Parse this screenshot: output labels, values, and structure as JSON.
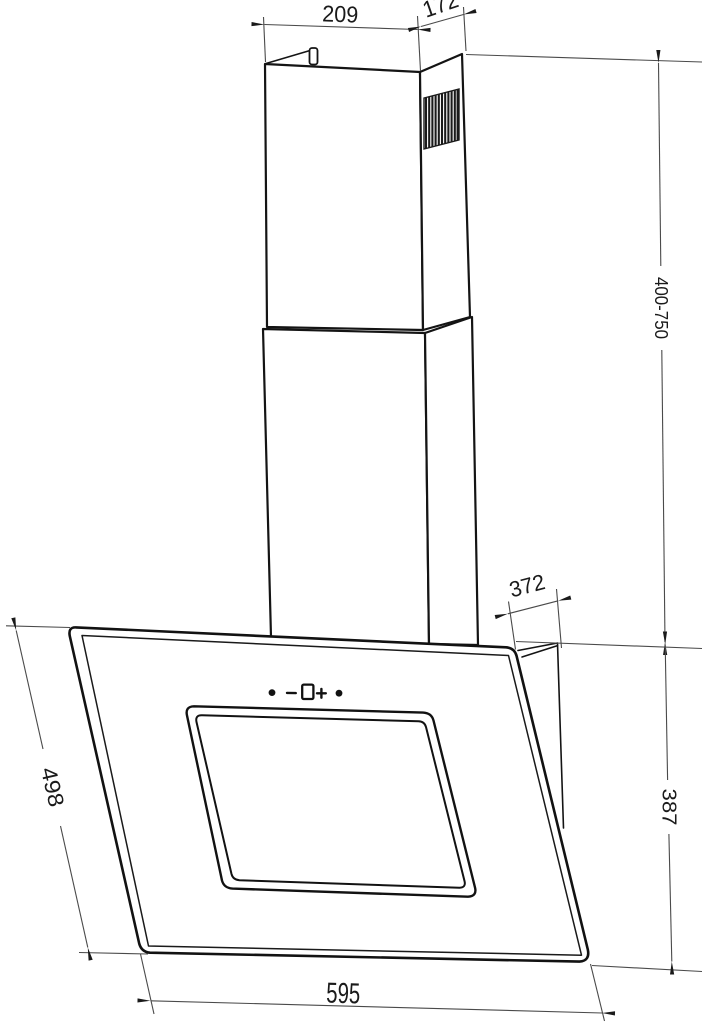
{
  "drawing": {
    "background_color": "#ffffff",
    "outline_color": "#121212",
    "dimension_line_color": "#4a4a4a",
    "text_color": "#1a1a1a",
    "dimensions": {
      "chimney_width": {
        "label": "209"
      },
      "chimney_depth": {
        "label": "172"
      },
      "chimney_height_range": {
        "label": "400-750"
      },
      "top_depth": {
        "label": "372"
      },
      "glass_panel_length": {
        "label": "498"
      },
      "body_width": {
        "label": "595"
      },
      "body_height": {
        "label": "387"
      }
    },
    "control_icons": [
      "dot",
      "minus",
      "display-square",
      "plus",
      "dot"
    ]
  }
}
